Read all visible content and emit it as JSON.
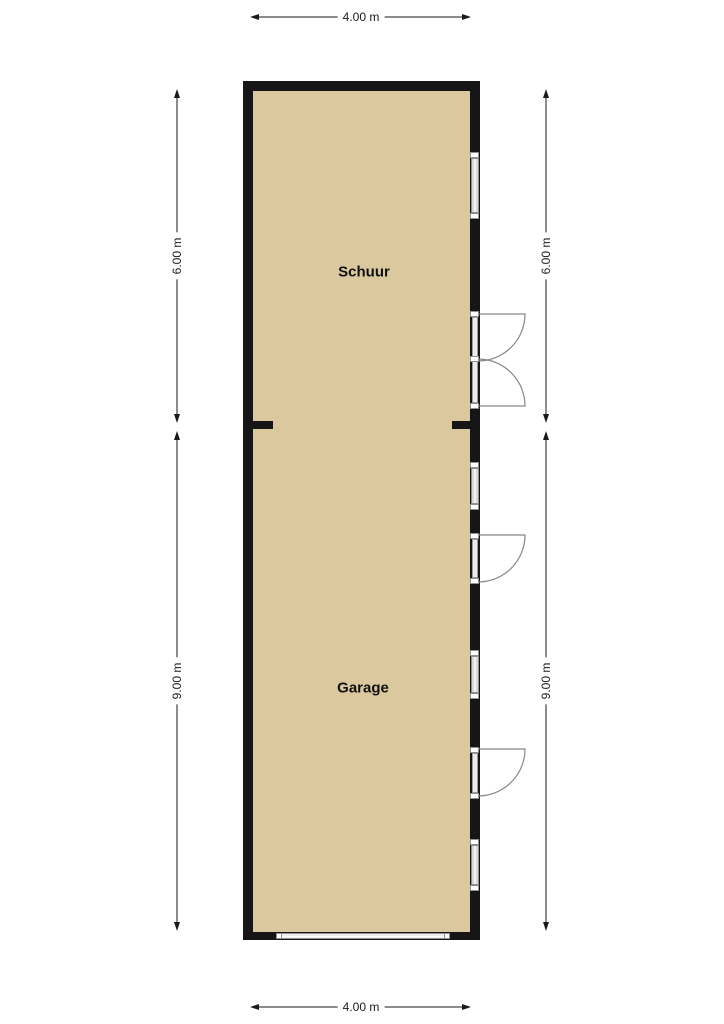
{
  "floorplan": {
    "rooms": [
      {
        "label": "Schuur"
      },
      {
        "label": "Garage"
      }
    ],
    "dimensions": {
      "top": "4.00 m",
      "bottom": "4.00 m",
      "left_upper": "6.00 m",
      "left_lower": "9.00 m",
      "right_upper": "6.00 m",
      "right_lower": "9.00 m"
    },
    "colors": {
      "floor": "#dbc89e",
      "wall": "#161616",
      "door-line": "#878787",
      "dim-line": "#1a1a1a",
      "glass-border": "#8f8f8f"
    }
  }
}
